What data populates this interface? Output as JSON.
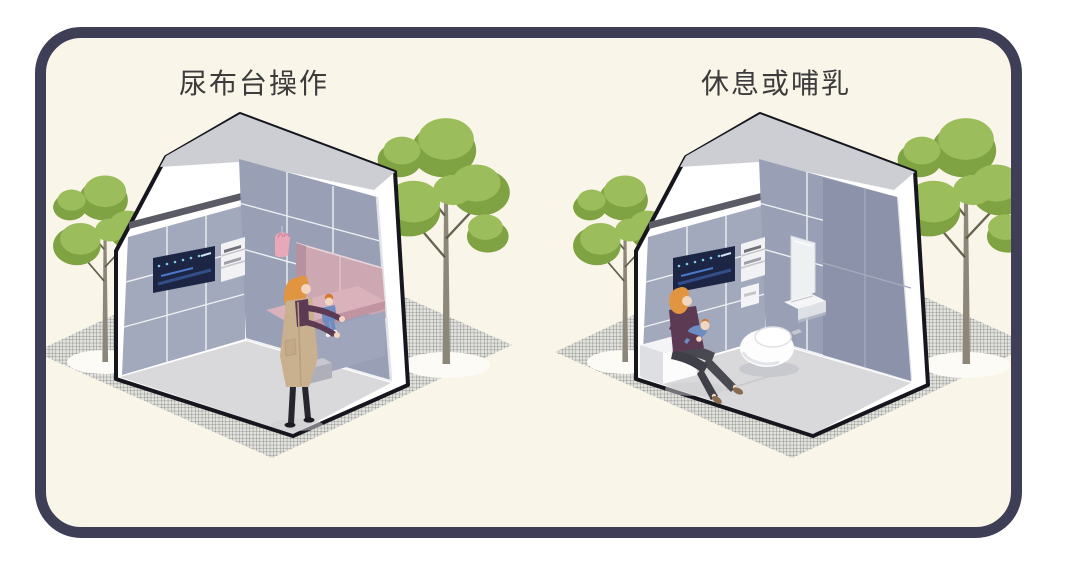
{
  "panels": {
    "left": {
      "title": "尿布台操作",
      "scene": "mother-changing-diaper"
    },
    "right": {
      "title": "休息或哺乳",
      "scene": "mother-nursing-baby"
    }
  },
  "palette": {
    "page_background": "#ffffff",
    "card_background": "#faf5e9",
    "card_border": "#3e3e56",
    "title_text": "#3c3c3c",
    "building_outline": "#16161e",
    "roof_gray": "#cdced4",
    "tile_wall": "#9aa0b6",
    "tile_wall_dark": "#8c92a9",
    "floor": "#d9d9db",
    "pink_changing_area": "#cda8b3",
    "pink_counter": "#dab2bc",
    "screen_panel": "#1c2543",
    "screen_lights": "#7ecbe8",
    "foliage_light": "#9cbd5c",
    "foliage_dark": "#7fa342",
    "trunk": "#8d8779",
    "ground_hatch_line": "#55554f",
    "hair_orange": "#e29540",
    "sweater_purple": "#5c3a54",
    "vest_tan": "#c9b08f",
    "baby_blue": "#6d8cc2"
  }
}
